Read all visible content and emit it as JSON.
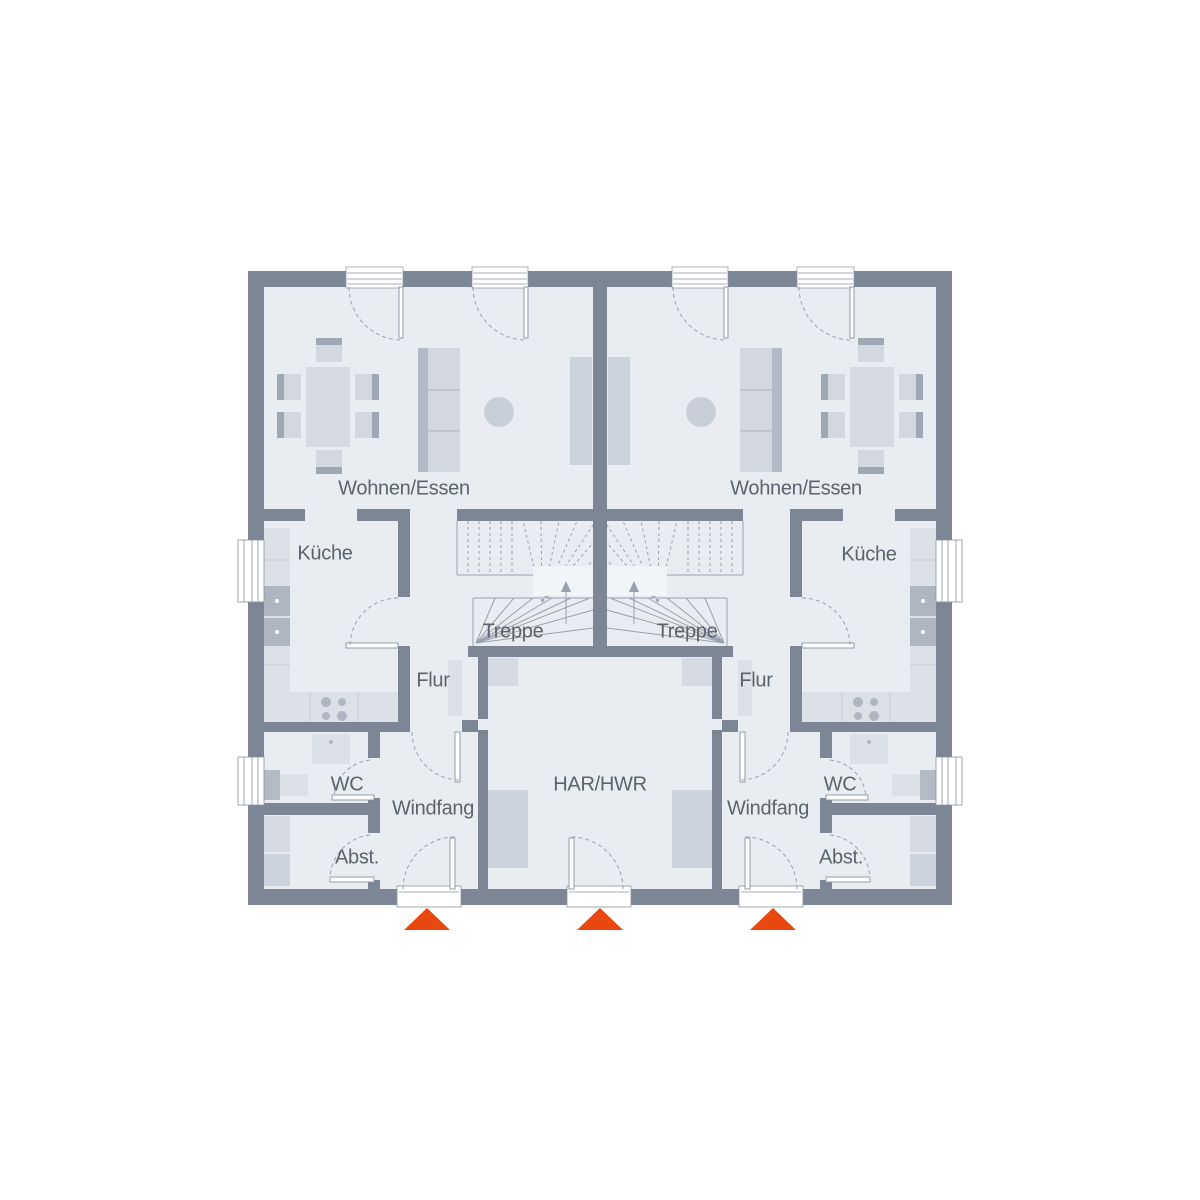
{
  "plan": {
    "type": "floor-plan-ground-floor-duplex",
    "labels": {
      "living": "Wohnen/Essen",
      "kitchen": "Küche",
      "stairs": "Treppe",
      "hall": "Flur",
      "utility": "HAR/HWR",
      "wc": "WC",
      "vestibule": "Windfang",
      "storage": "Abst."
    },
    "colors": {
      "wall": "#7D8694",
      "floor": "#E9EDF2",
      "furniture_light": "#DCE0E7",
      "furniture_mid": "#CDD3DC",
      "furniture_dark": "#AEB6C2",
      "line": "#8A93A0",
      "text": "#5A6370",
      "entrance_accent": "#E8480F",
      "background": "#FFFFFF"
    },
    "entrance_markers": {
      "count": 3,
      "direction": "up"
    }
  }
}
